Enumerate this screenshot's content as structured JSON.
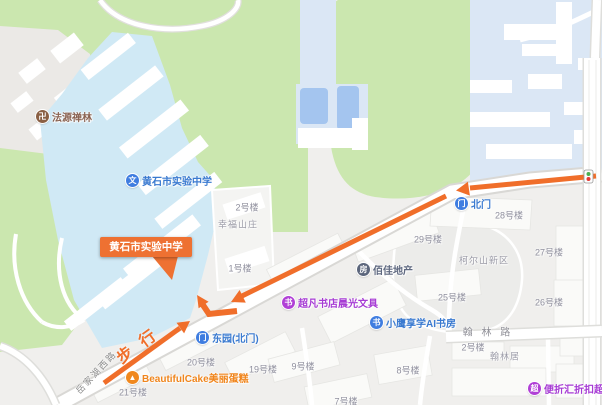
{
  "route": {
    "walk_label": "步行"
  },
  "callout": {
    "text": "黄石市实验中学"
  },
  "roads": {
    "yuejiahu_west": "岳家湖西路",
    "hanlin": "翰 林 路"
  },
  "pois": {
    "fayuan": {
      "label": "法源禅林",
      "glyph": "卍"
    },
    "school": {
      "label": "黄石市实验中学",
      "glyph": "文"
    },
    "dongyuan_gate": {
      "label": "东园(北门)",
      "glyph": "门"
    },
    "north_gate": {
      "label": "北门",
      "glyph": "门"
    },
    "chaofan": {
      "label": "超凡书店晨光文具",
      "glyph": "书"
    },
    "xiaoying": {
      "label": "小鹰享学AI书房",
      "glyph": "书"
    },
    "baijia": {
      "label": "佰佳地产",
      "glyph": "房"
    },
    "cake": {
      "label": "BeautifulCake美丽蛋糕",
      "glyph": "▲"
    },
    "discount": {
      "label": "便折汇折扣超市",
      "glyph": "超"
    }
  },
  "buildings": {
    "b2": "2号楼",
    "xingfu": "幸福山庄",
    "b1": "1号楼",
    "b20": "20号楼",
    "b19": "19号楼",
    "b21": "21号楼",
    "b9": "9号楼",
    "b8": "8号楼",
    "b7": "7号楼",
    "b28": "28号楼",
    "b29": "29号楼",
    "b27": "27号楼",
    "b26": "26号楼",
    "b25": "25号楼",
    "keershan": "柯尔山新区",
    "hanlin_b2": "2号楼",
    "hanlinju": "翰林居"
  },
  "colors": {
    "route_arrow": "#f06e2a",
    "callout_bg": "#ee7132",
    "poi_blue": "#3f7de0",
    "poi_purple": "#b03fd6",
    "poi_orange": "#f0881e",
    "poi_brown": "#8a6044",
    "poi_dark": "#5c667c",
    "park_green": "#cbe7af",
    "water_blue": "#d0e9f5",
    "residential_blue": "#dbe7f5"
  }
}
